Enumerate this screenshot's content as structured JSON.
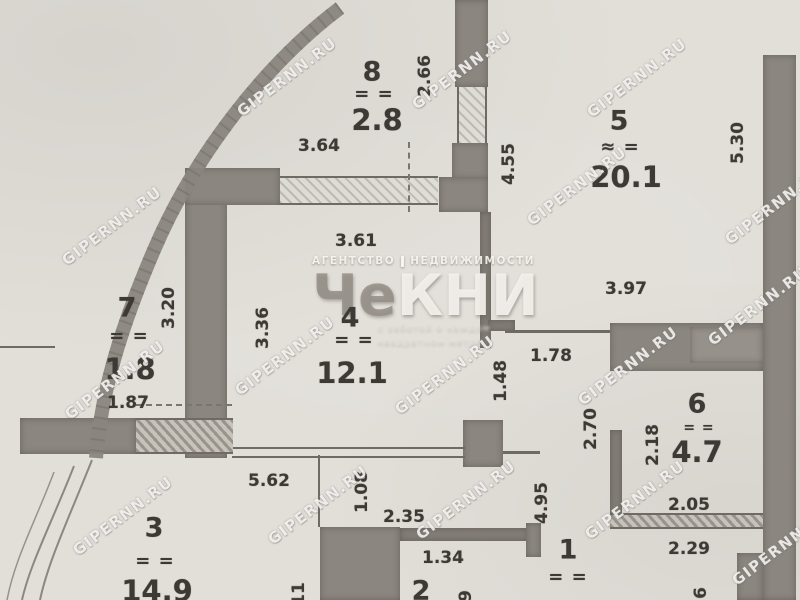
{
  "plan": {
    "watermark": "GIPERNN.RU",
    "logo": {
      "line1a": "АГЕНТСТВО",
      "line1b": "НЕДВИЖИМОСТИ",
      "name_a": "Че",
      "name_b": "КНИ",
      "tagline1": "с заботой о каждом",
      "tagline2": "квадратном метре"
    },
    "rooms": [
      {
        "number": "8",
        "mark": "= =",
        "area": "2.8"
      },
      {
        "number": "5",
        "mark": "≈ =",
        "area": "20.1"
      },
      {
        "number": "7",
        "mark": "= =",
        "area": "1.8"
      },
      {
        "number": "4",
        "mark": "= =",
        "area": "12.1"
      },
      {
        "number": "6",
        "mark": "= =",
        "area": "4.7"
      },
      {
        "number": "3",
        "mark": "= =",
        "area": "14.9"
      },
      {
        "number": "1",
        "mark": "= ="
      },
      {
        "number": "2"
      }
    ],
    "dims": [
      "3.64",
      "2.66",
      "4.55",
      "5.30",
      "3.61",
      "3.20",
      "3.36",
      "1.87",
      "1.78",
      "1.48",
      "3.97",
      "2.70",
      "2.18",
      "2.05",
      "2.29",
      "5.62",
      "2.35",
      "1.34",
      "1.08",
      "4.95",
      "11",
      "9",
      "6"
    ],
    "colors": {
      "paper": "#e2dfd9",
      "wall": "#8b867f",
      "ink": "#3d3935",
      "watermark": "#ffffff"
    }
  }
}
